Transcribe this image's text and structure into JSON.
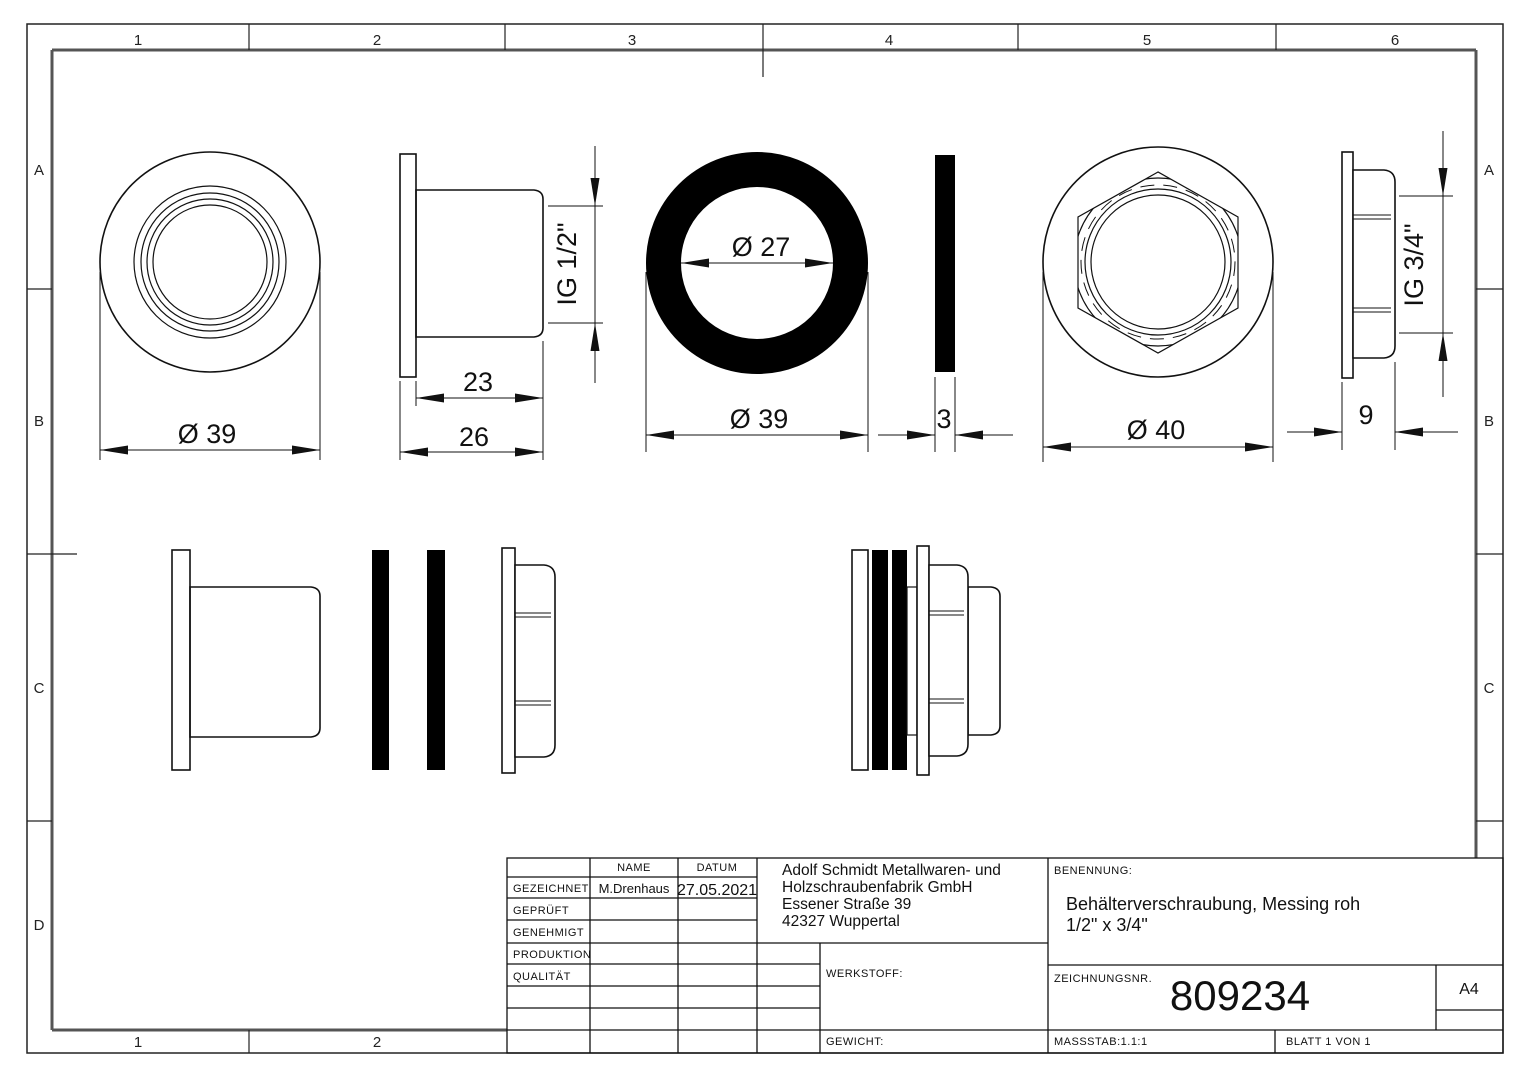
{
  "zones": {
    "top": [
      "1",
      "2",
      "3",
      "4",
      "5",
      "6"
    ],
    "bottom": [
      "1",
      "2"
    ],
    "left": [
      "A",
      "B",
      "C",
      "D"
    ],
    "right": [
      "A",
      "B",
      "C"
    ]
  },
  "dimensions": {
    "bushing_front_diameter": "Ø 39",
    "thread_length": "23",
    "bushing_length": "26",
    "bushing_thread": "IG 1/2\"",
    "gasket_inner_diameter": "Ø 27",
    "gasket_outer_diameter": "Ø 39",
    "gasket_thickness": "3",
    "nut_outer_diameter": "Ø 40",
    "nut_width": "9",
    "nut_thread": "IG 3/4\""
  },
  "title_block": {
    "name_header": "NAME",
    "date_header": "DATUM",
    "rows": {
      "gezeichnet": {
        "label": "GEZEICHNET",
        "name": "M.Drenhaus",
        "date": "27.05.2021"
      },
      "geprueft": {
        "label": "GEPRÜFT"
      },
      "genehmigt": {
        "label": "GENEHMIGT"
      },
      "produktion": {
        "label": "PRODUKTION"
      },
      "qualitaet": {
        "label": "QUALITÄT"
      }
    },
    "company": [
      "Adolf Schmidt Metallwaren- und",
      "Holzschraubenfabrik GmbH",
      "Essener Straße 39",
      "42327 Wuppertal"
    ],
    "benennung_label": "BENENNUNG:",
    "benennung_line1": "Behälterverschraubung, Messing roh",
    "benennung_line2": "1/2\" x 3/4\"",
    "werkstoff_label": "WERKSTOFF:",
    "gewicht_label": "GEWICHT:",
    "zeichnungsnr_label": "ZEICHNUNGSNR.",
    "zeichnungsnr": "809234",
    "format": "A4",
    "massstab": "MASSSTAB:1.1:1",
    "blatt": "BLATT 1 VON 1"
  }
}
